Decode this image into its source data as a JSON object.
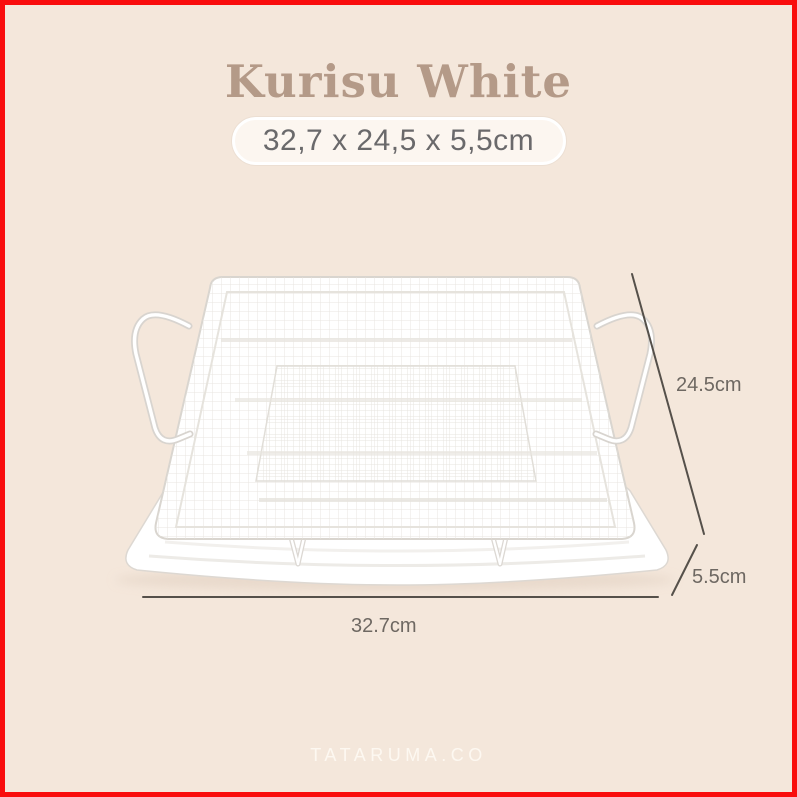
{
  "page": {
    "background_color": "#f4e7db",
    "border_color": "#f90d0d"
  },
  "header": {
    "title": "Kurisu White",
    "title_color": "#b49a88",
    "size_badge_text": "32,7 x 24,5 x 5,5cm",
    "size_badge_bg": "#fcf6f0",
    "size_badge_text_color": "#6a696b"
  },
  "product": {
    "image_name": "white-mesh-crisper-basket-on-tray"
  },
  "dimensions": {
    "line_color": "#55504a",
    "label_color": "#6e6862",
    "height_label": "24.5cm",
    "depth_label": "5.5cm",
    "width_label": "32.7cm"
  },
  "footer": {
    "watermark": "TATARUMA.CO",
    "watermark_color": "#fdf8f1"
  }
}
